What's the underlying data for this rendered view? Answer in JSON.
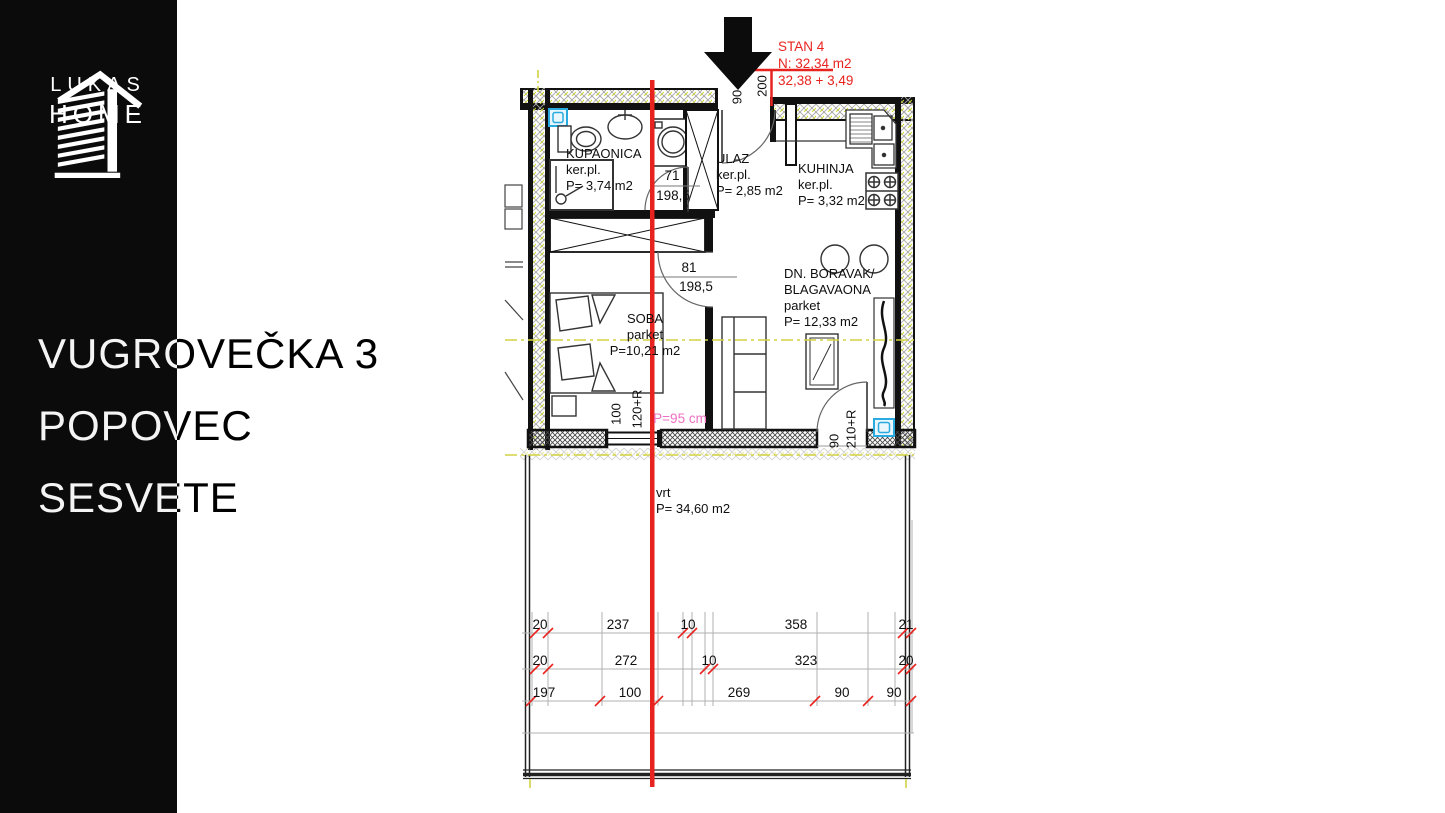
{
  "sidebar": {
    "logo_line1": "LUKAS",
    "logo_line2": "HOME",
    "address_line1": "VUGROVEČKA 3",
    "address_line2": "POPOVEC",
    "address_line3": "SESVETE"
  },
  "unit_info": {
    "title": "STAN 4",
    "net_area": "N: 32,34 m2",
    "area_sum": "32,38 + 3,49"
  },
  "rooms": {
    "kupaonica": {
      "name": "KUPAONICA",
      "floor": "ker.pl.",
      "area": "P= 3,74 m2"
    },
    "ulaz": {
      "name": "ULAZ",
      "floor": "ker.pl.",
      "area": "P= 2,85 m2"
    },
    "kuhinja": {
      "name": "KUHINJA",
      "floor": "ker.pl.",
      "area": "P= 3,32 m2"
    },
    "soba": {
      "name": "SOBA",
      "floor": "parket",
      "area": "P=10,21 m2"
    },
    "dnevni": {
      "name_line1": "DN. BORAVAK/",
      "name_line2": "BLAGAVAONA",
      "floor": "parket",
      "area": "P= 12,33 m2"
    },
    "vrt": {
      "name": "vrt",
      "area": "P= 34,60 m2"
    }
  },
  "openings": {
    "bath_door_w": "71",
    "bath_door_h": "198,5",
    "soba_door_w": "81",
    "soba_door_h": "198,5",
    "entry_w": "90",
    "entry_h": "200",
    "balcony_w": "90",
    "balcony_h": "210+R",
    "window_w": "100",
    "window_h": "120+R",
    "parapet": "P=95 cm"
  },
  "dimensions": {
    "row1": [
      "20",
      "237",
      "10",
      "358",
      "21"
    ],
    "row2": [
      "20",
      "272",
      "10",
      "323",
      "20"
    ],
    "row3": [
      "197",
      "100",
      "269",
      "90",
      "90"
    ]
  },
  "icons": {
    "logo": "building-stripes-icon",
    "arrow": "entrance-arrow-down-icon",
    "drain1": "floor-drain-icon",
    "drain2": "floor-drain-icon"
  },
  "colors": {
    "accent_red": "#e8231f",
    "marker_yellow": "#d2d243",
    "parapet_pink": "#ee6fc3",
    "symbol_blue": "#29abe2"
  }
}
